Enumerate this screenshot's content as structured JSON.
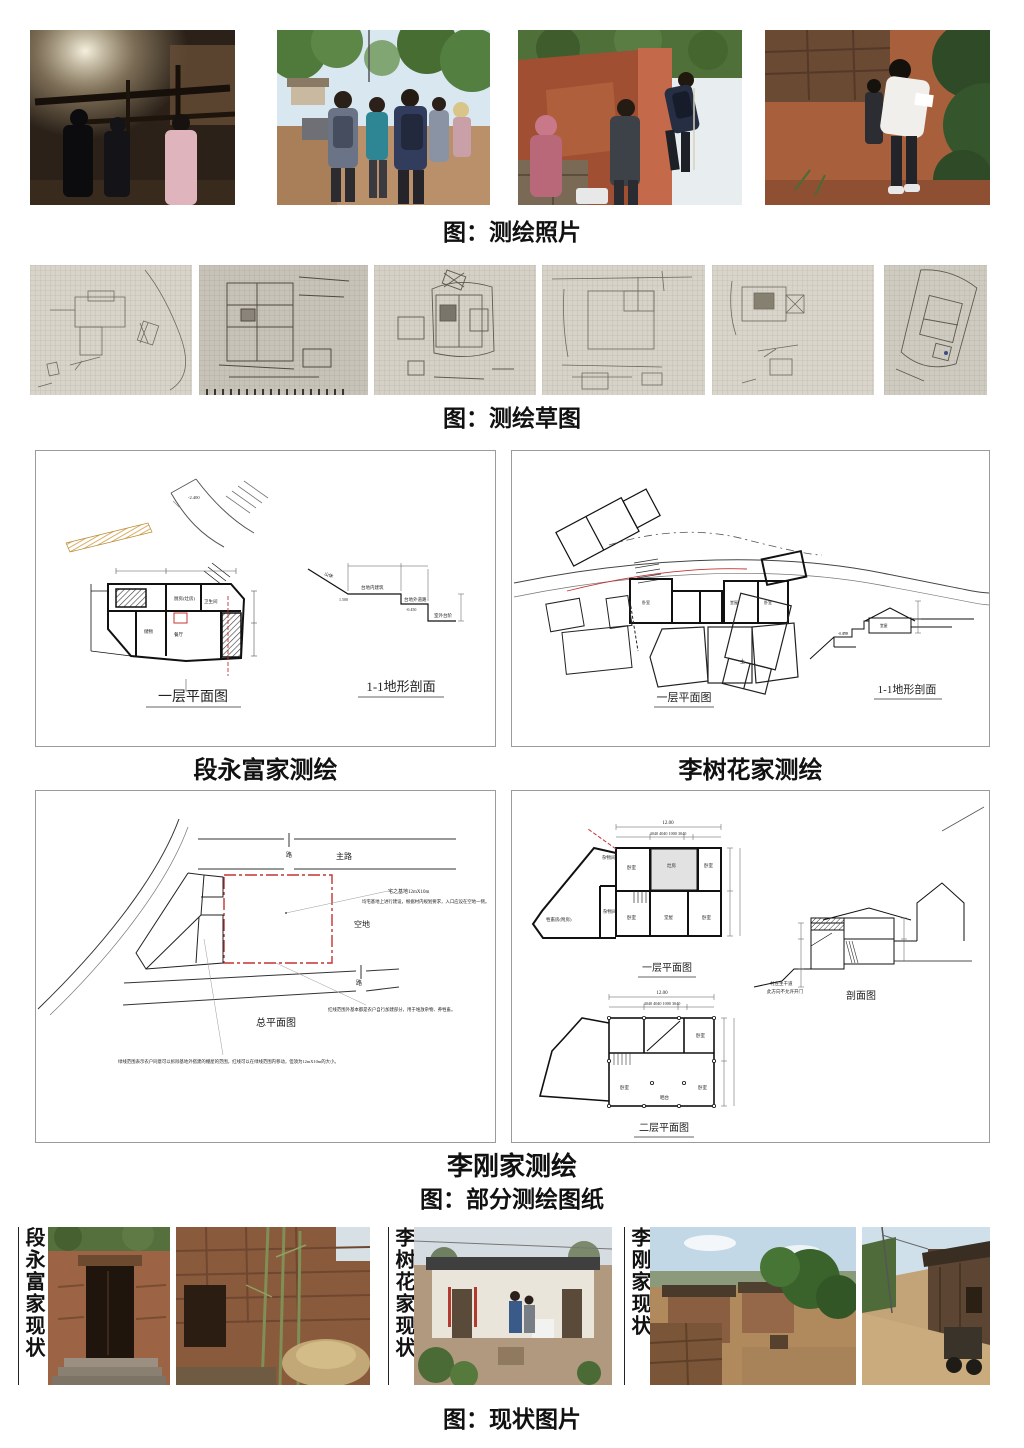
{
  "captions": {
    "photos": "图：测绘照片",
    "sketches": "图：测绘草图",
    "drawings": "图：部分测绘图纸",
    "current": "图：现状图片"
  },
  "colors": {
    "red_accent": "#c43434",
    "orange_hatch": "#cf9a3f"
  },
  "panels": {
    "duan": {
      "title": "段永富家测绘",
      "plan_label": "一层平面图",
      "section_label": "1-1地形剖面",
      "rooms": [
        "厨房(灶房)",
        "卫生间",
        "储物",
        "餐厅"
      ],
      "section_notes": [
        "山体",
        "台地内建筑",
        "台地外道路",
        "室外台阶"
      ]
    },
    "lishuhua": {
      "title": "李树花家测绘",
      "plan_label": "一层平面图",
      "section_label": "1-1地形剖面",
      "soil_char": "土"
    },
    "ligang": {
      "title": "李刚家测绘",
      "site": {
        "label": "总平面图",
        "main_road": "主路",
        "road_char": "路",
        "empty_lot": "空地",
        "note_size": "宅之基地12mX10m",
        "note_build": "均宅基地上进行建设，根据村内规划要求，入口应设在空地一侧。",
        "note_redline": "红线范围外基本都是农户自行加建部分，用于堆放杂物、养牲畜。",
        "note_greenline": "绿线范围表示农户同意可以拆除基地外搭建的棚屋的范围，红线可以在绿线范围内移动，但须为12mX10m的大小。"
      },
      "floor1": {
        "label": "一层平面图",
        "dim_total": "12.00",
        "dims": "4040      4040      1000      3040",
        "rooms": [
          "杂物间",
          "卧室",
          "灶房",
          "卧室",
          "牲畜房(附房)",
          "杂物间",
          "卧室",
          "堂屋",
          "卧室"
        ]
      },
      "floor2": {
        "label": "二层平面图",
        "dim_total": "12.00",
        "dims": "4040      4040      1000      3040",
        "rooms": [
          "卧室",
          "卧室",
          "卧室",
          "晒台"
        ]
      },
      "section": {
        "label": "剖面图",
        "road_note": "村庄主干道",
        "red_note": "此方向不允许开门"
      }
    }
  },
  "current_state": {
    "groups": [
      {
        "label": "段永富家现状"
      },
      {
        "label": "李树花家现状"
      },
      {
        "label": "李刚家现状"
      }
    ]
  }
}
